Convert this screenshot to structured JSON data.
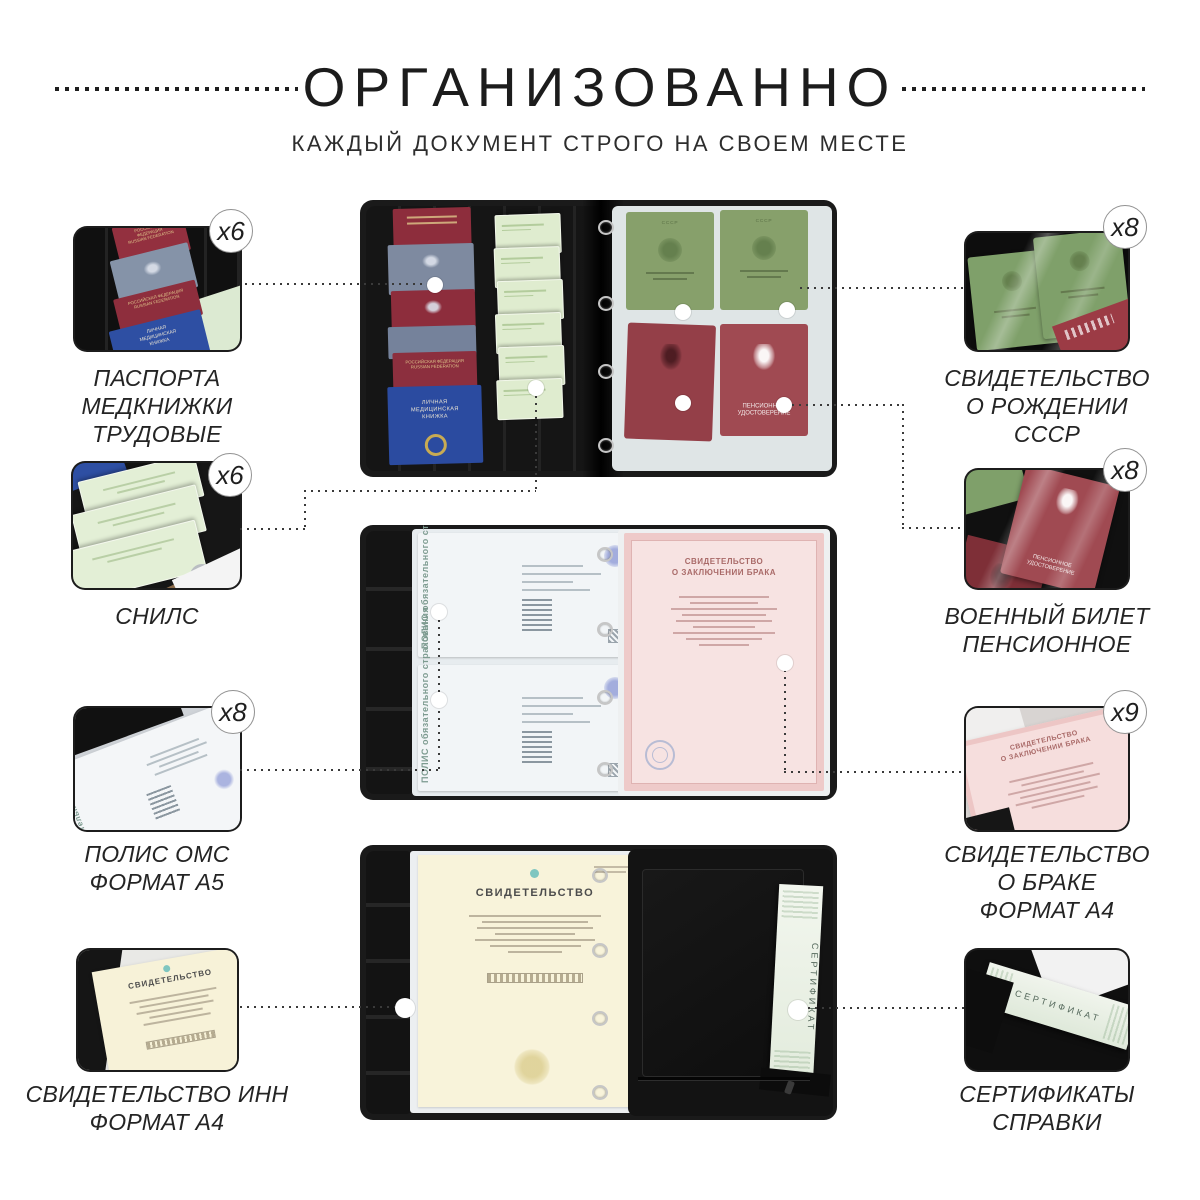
{
  "header": {
    "title": "ОРГАНИЗОВАННО",
    "subtitle": "КАЖДЫЙ ДОКУМЕНТ СТРОГО НА СВОЕМ МЕСТЕ"
  },
  "left_items": [
    {
      "count": "x6",
      "label": "ПАСПОРТА\nМЕДКНИЖКИ\nТРУДОВЫЕ"
    },
    {
      "count": "x6",
      "label": "СНИЛС"
    },
    {
      "count": "x8",
      "label": "ПОЛИС ОМС\nФОРМАТ А5"
    },
    {
      "label": "СВИДЕТЕЛЬСТВО ИНН\nФОРМАТ А4"
    }
  ],
  "right_items": [
    {
      "count": "x8",
      "label": "СВИДЕТЕЛЬСТВО\nО РОЖДЕНИИ\nСССР"
    },
    {
      "count": "x8",
      "label": "ВОЕННЫЙ БИЛЕТ\nПЕНСИОННОЕ"
    },
    {
      "count": "x9",
      "label": "СВИДЕТЕЛЬСТВО\nО БРАКЕ\nФОРМАТ А4"
    },
    {
      "label": "СЕРТИФИКАТЫ\nСПРАВКИ"
    }
  ],
  "photo_texts": {
    "russian_federation": "РОССИЙСКАЯ ФЕДЕРАЦИЯ\nRUSSIAN FEDERATION",
    "medical_book": "ЛИЧНАЯ\nМЕДИЦИНСКАЯ\nКНИЖКА",
    "ussr": "СССР",
    "pension_id": "ПЕНСИОННОЕ\nУДОСТОВЕРЕНИЕ",
    "polis": "ПОЛИС обязательного страхования",
    "marriage_title": "СВИДЕТЕЛЬСТВО\nО ЗАКЛЮЧЕНИИ БРАКА",
    "certificate_title": "СВИДЕТЕЛЬСТВО",
    "sertifikat": "СЕРТИФИКАТ"
  },
  "colors": {
    "text": "#212121",
    "dotted_lines": "#3a3a3a",
    "badge_border": "#929292",
    "background": "#ffffff"
  }
}
